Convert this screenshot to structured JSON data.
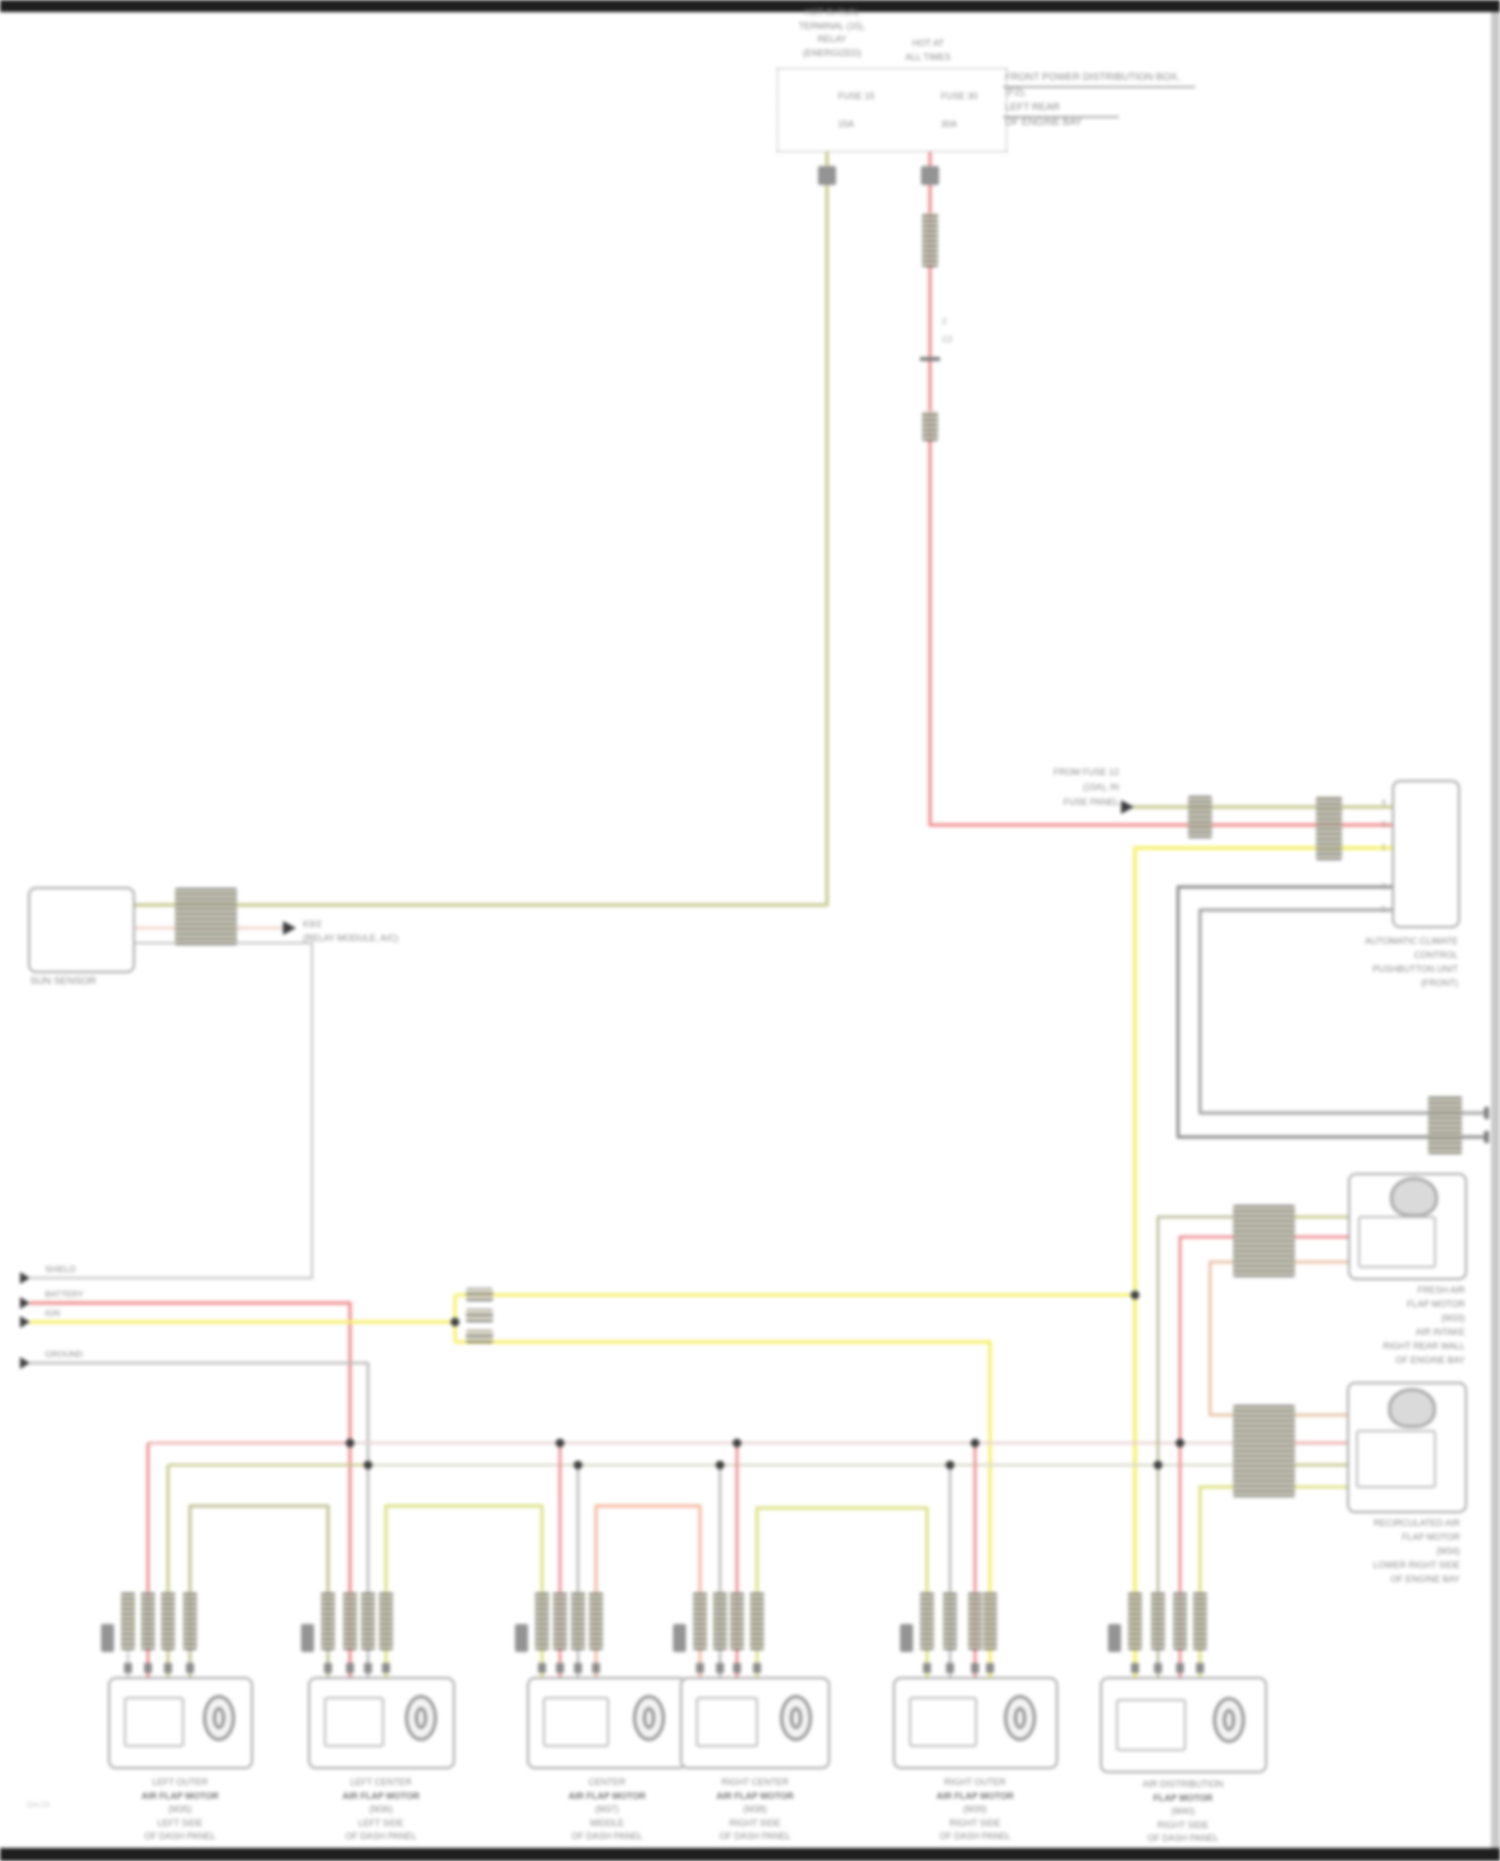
{
  "colors": {
    "wire_red": "#ef9292",
    "wire_olive": "#c9cc92",
    "wire_yellow": "#f6f06e",
    "wire_chartreuse": "#dde285",
    "wire_salmon": "#f3bba2",
    "wire_tan": "#e8c3a8",
    "wire_gray": "#b9b9b9",
    "wire_dark_gray": "#8f8f8f",
    "wire_pale_pink": "#f2d8d2",
    "bus_red": "#eeaaaa",
    "bus_olive": "#c6c68c"
  },
  "top": {
    "relay_label": {
      "l1": "HOT IN RUN,",
      "l2": "TERMINAL (15),",
      "l3": "RELAY",
      "l4": "(ENERGIZED)"
    },
    "hot_label": {
      "l1": "HOT AT",
      "l2": "ALL TIMES"
    },
    "box_note": {
      "l1": "FRONT POWER DISTRIBUTION BOX,",
      "l2": "(F2),",
      "l3": "LEFT REAR",
      "l4": "OF ENGINE BAY"
    },
    "fuse1": {
      "name": "FUSE 15",
      "amps": "15A"
    },
    "fuse2": {
      "name": "FUSE 30",
      "amps": "30A"
    },
    "red_wire_mark1": "2",
    "red_wire_mark2": "C2"
  },
  "source_arrow": {
    "l1": "FROM FUSE 12",
    "l2": "(15A), IN",
    "l3": "FUSE PANEL"
  },
  "sensor": {
    "name": "SUN SENSOR",
    "out1": "K9/2",
    "out2": "(RELAY MODULE, A/C)"
  },
  "left_wires": {
    "shield": "SHIELD",
    "battery": "BATTERY",
    "ignition": "IGN",
    "ground": "GROUND"
  },
  "module": {
    "label": {
      "l1": "AUTOMATIC CLIMATE",
      "l2": "CONTROL",
      "l3": "PUSHBUTTON UNIT",
      "l4": "(FRONT)"
    },
    "pins": {
      "p1": "4",
      "p2": "2",
      "p3": "1",
      "p4": "6",
      "p5": "5"
    }
  },
  "comp_a": {
    "label": {
      "l1": "FRESH AIR",
      "l2": "FLAP MOTOR",
      "l3": "(M33)",
      "l4": "AIR INTAKE",
      "l5": "RIGHT REAR WALL",
      "l6": "OF ENGINE BAY"
    }
  },
  "comp_b": {
    "label": {
      "l1": "RECIRCULATED AIR",
      "l2": "FLAP MOTOR",
      "l3": "(M34)",
      "l4": "LOWER RIGHT SIDE",
      "l5": "OF ENGINE BAY"
    }
  },
  "bottom": [
    {
      "lines": {
        "l1": "LEFT OUTER",
        "l2": "AIR FLAP MOTOR",
        "l3": "(M35)",
        "l4": "LEFT SIDE",
        "l5": "OF DASH PANEL"
      }
    },
    {
      "lines": {
        "l1": "LEFT CENTER",
        "l2": "AIR FLAP MOTOR",
        "l3": "(M36)",
        "l4": "LEFT SIDE",
        "l5": "OF DASH PANEL"
      }
    },
    {
      "lines": {
        "l1": "CENTER",
        "l2": "AIR FLAP MOTOR",
        "l3": "(M37)",
        "l4": "MIDDLE",
        "l5": "OF DASH PANEL"
      }
    },
    {
      "lines": {
        "l1": "RIGHT CENTER",
        "l2": "AIR FLAP MOTOR",
        "l3": "(M38)",
        "l4": "RIGHT SIDE",
        "l5": "OF DASH PANEL"
      }
    },
    {
      "lines": {
        "l1": "RIGHT OUTER",
        "l2": "AIR FLAP MOTOR",
        "l3": "(M39)",
        "l4": "RIGHT SIDE",
        "l5": "OF DASH PANEL"
      }
    },
    {
      "lines": {
        "l1": "AIR DISTRIBUTION",
        "l2": "FLAP MOTOR",
        "l3": "(M40)",
        "l4": "RIGHT SIDE",
        "l5": "OF DASH PANEL"
      }
    }
  ],
  "watermark": "104-23"
}
